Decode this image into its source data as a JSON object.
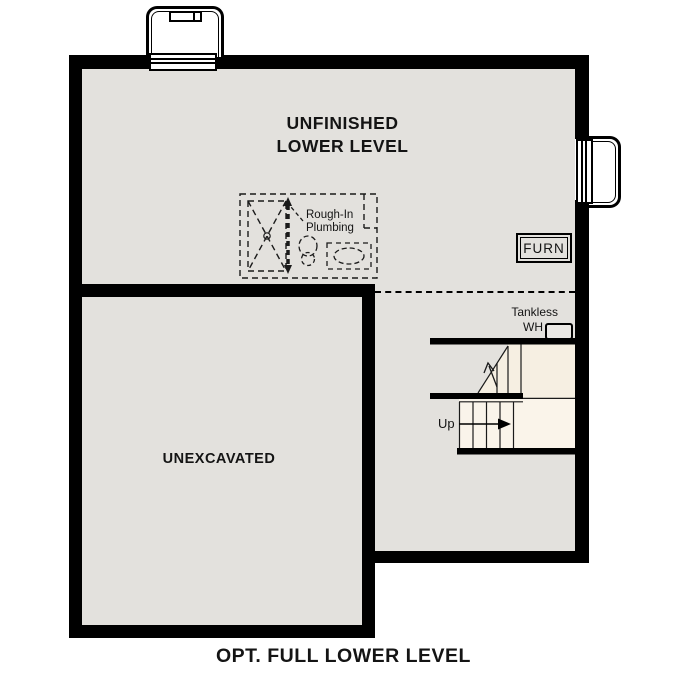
{
  "colors": {
    "wall": "#000000",
    "room": "#e3e1dd",
    "stair": "#f6efe2",
    "treads": "#faf4ea",
    "paper": "#ffffff",
    "ink": "#141414"
  },
  "plan": {
    "caption": "OPT. FULL LOWER LEVEL",
    "unfinished_room": {
      "line1": "UNFINISHED",
      "line2": "LOWER LEVEL"
    },
    "unexcavated_room": {
      "label": "UNEXCAVATED"
    },
    "plumbing": {
      "line1": "Rough-In",
      "line2": "Plumbing"
    },
    "furnace": {
      "label": "FURN"
    },
    "tankless": {
      "line1": "Tankless",
      "line2": "WH"
    },
    "stairs": {
      "up_label": "Up"
    }
  }
}
